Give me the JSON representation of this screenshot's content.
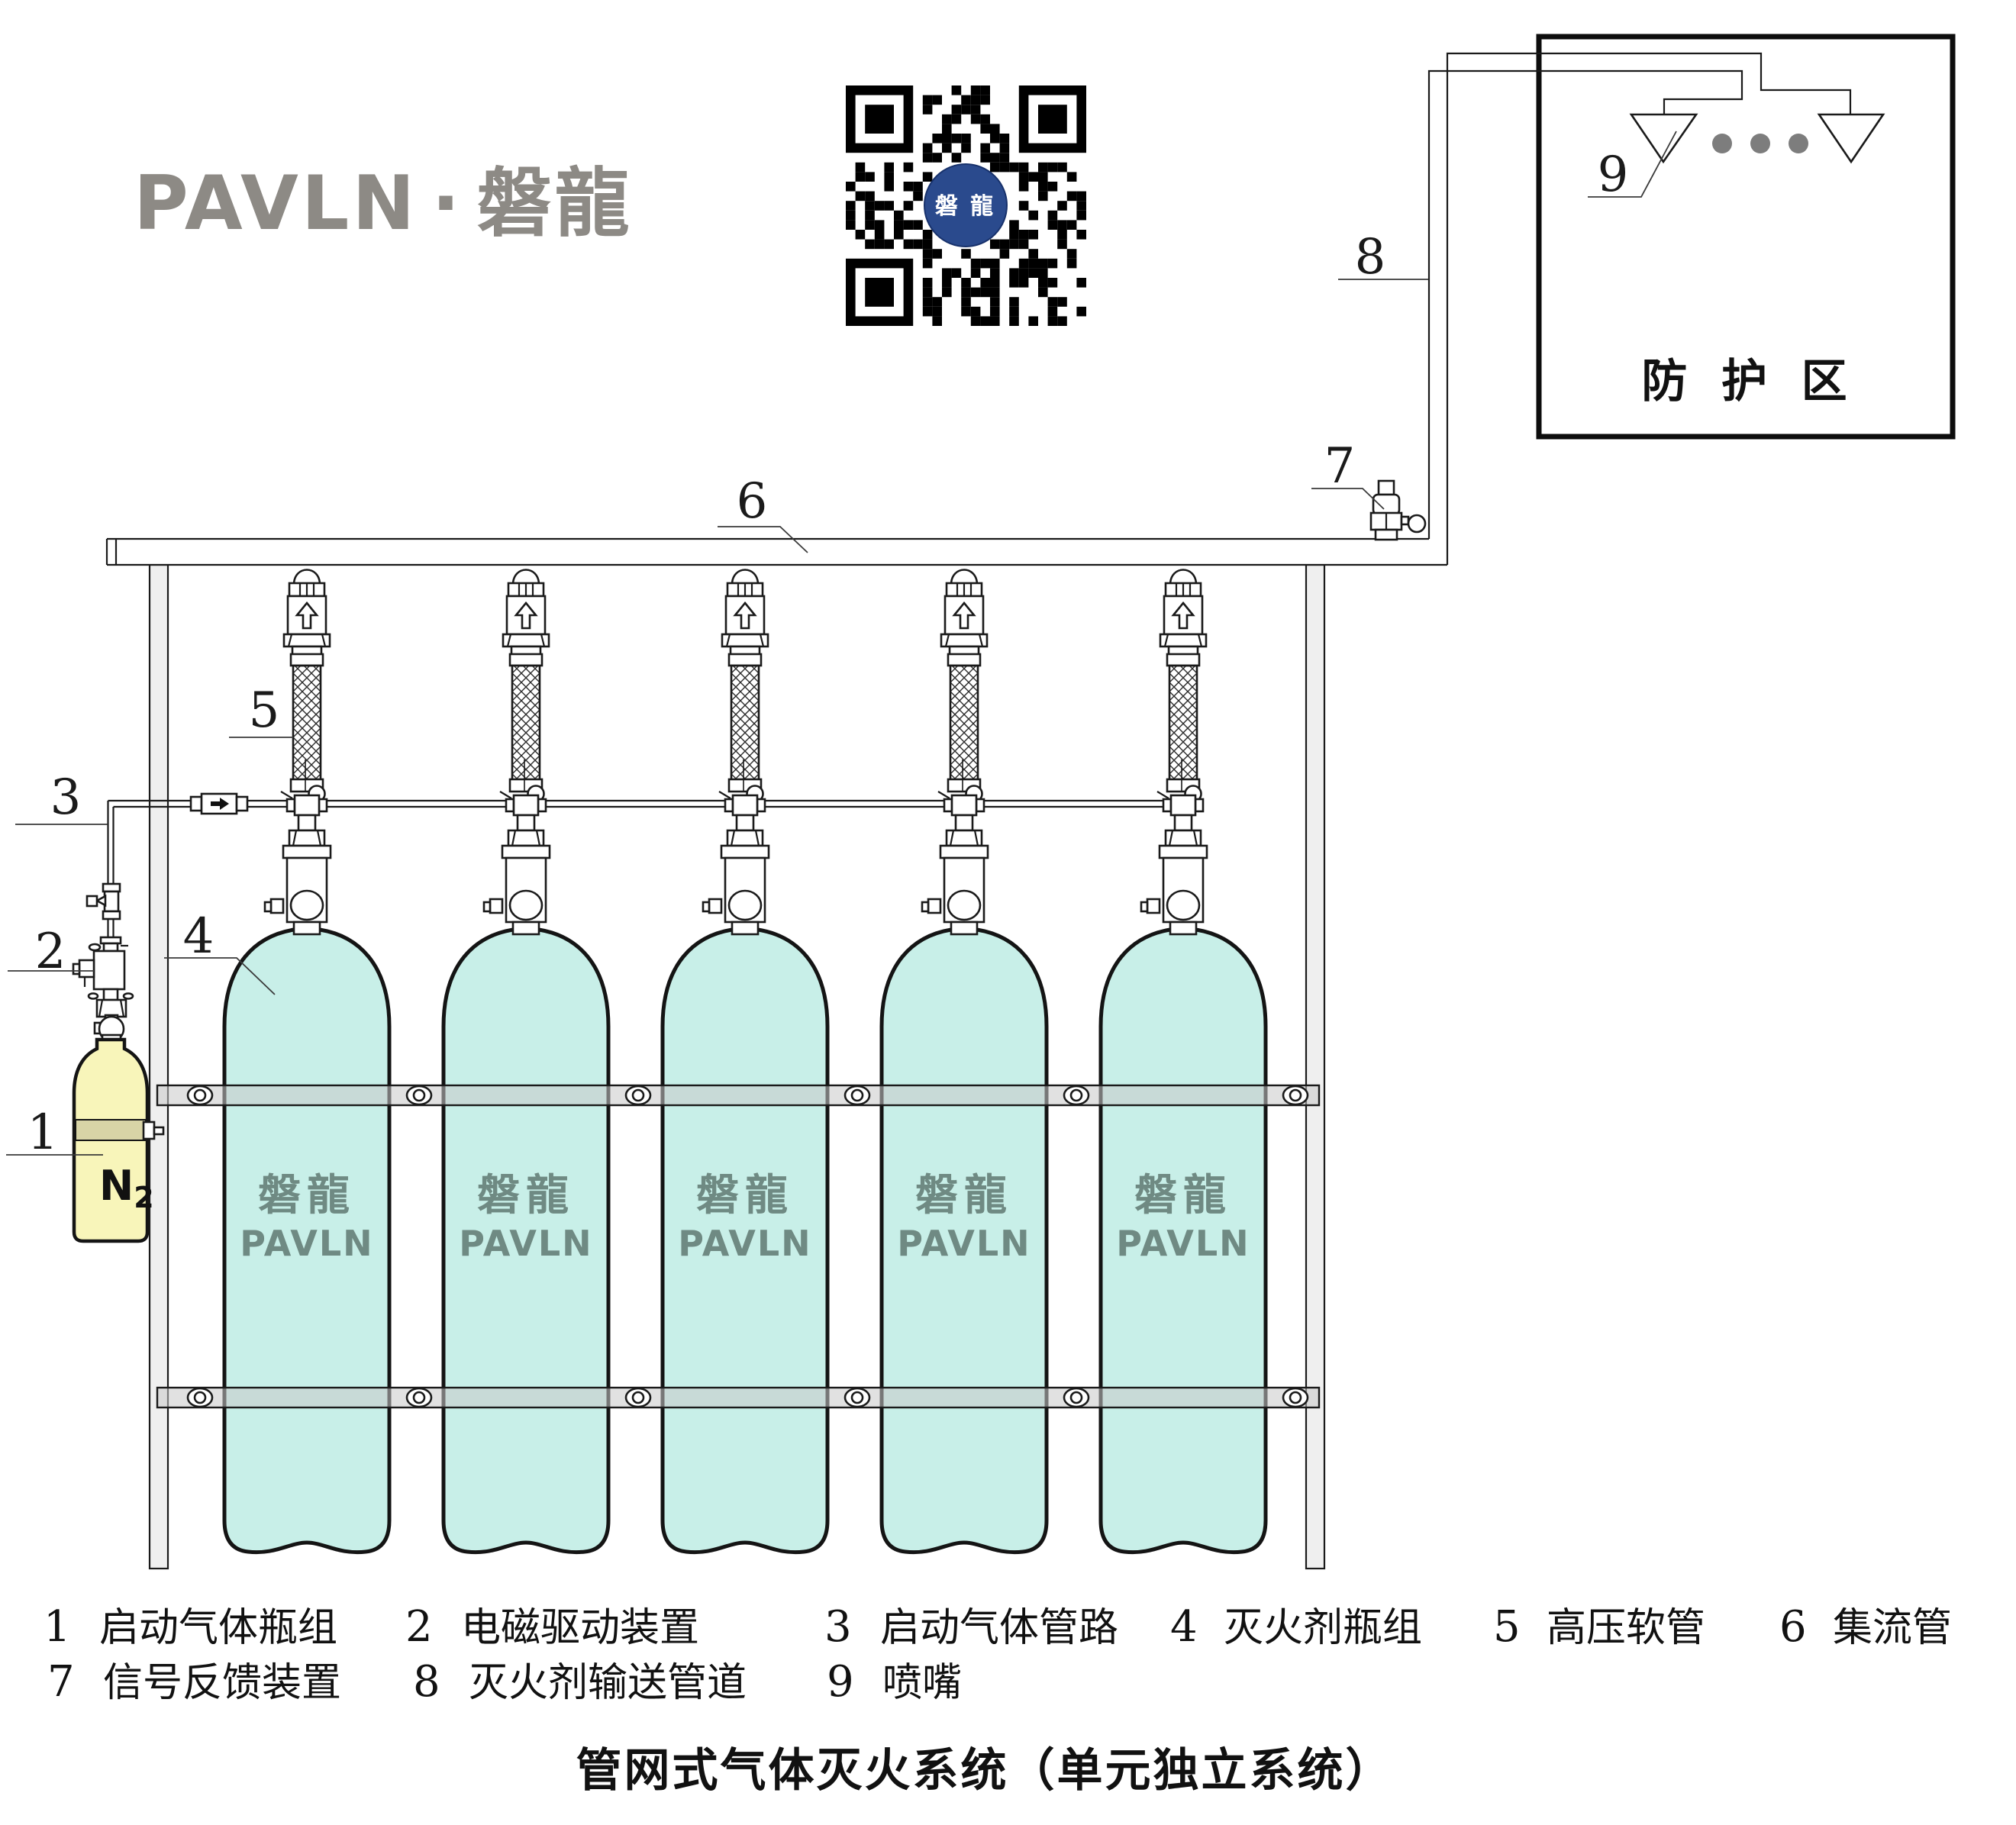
{
  "page": {
    "title": "管网式气体灭火系统（单元独立系统）"
  },
  "logo": {
    "latin": "PAVLN",
    "separator": "·",
    "cjk": "磐龍"
  },
  "qr": {
    "center_label": "磐 龍"
  },
  "protection_zone": {
    "label": "防 护 区"
  },
  "cylinder": {
    "brand_cn": "磐龍",
    "brand_en": "PAVLN",
    "count": 5
  },
  "starter_bottle": {
    "gas": "N",
    "gas_sub": "2"
  },
  "callouts": [
    {
      "num": "1"
    },
    {
      "num": "2"
    },
    {
      "num": "3"
    },
    {
      "num": "4"
    },
    {
      "num": "5"
    },
    {
      "num": "6"
    },
    {
      "num": "7"
    },
    {
      "num": "8"
    },
    {
      "num": "9"
    }
  ],
  "legend": {
    "rows": [
      [
        {
          "num": "1",
          "label": "启动气体瓶组"
        },
        {
          "num": "2",
          "label": "电磁驱动装置"
        },
        {
          "num": "3",
          "label": "启动气体管路"
        },
        {
          "num": "4",
          "label": "灭火剂瓶组"
        },
        {
          "num": "5",
          "label": "高压软管"
        },
        {
          "num": "6",
          "label": "集流管"
        }
      ],
      [
        {
          "num": "7",
          "label": "信号反馈装置"
        },
        {
          "num": "8",
          "label": "灭火剂输送管道"
        },
        {
          "num": "9",
          "label": "喷嘴"
        }
      ]
    ]
  },
  "colors": {
    "bottle": "#c8efe8",
    "brand": "#6f8a83",
    "n2_bottle": "#f8f5ba",
    "n2_band": "#d8d4a6",
    "qr_blue": "#2a4a8d",
    "logo_gray": "#8d8a85",
    "dot_gray": "#7d7d7d",
    "rail": "#d8d8d8",
    "post": "#efefef"
  }
}
